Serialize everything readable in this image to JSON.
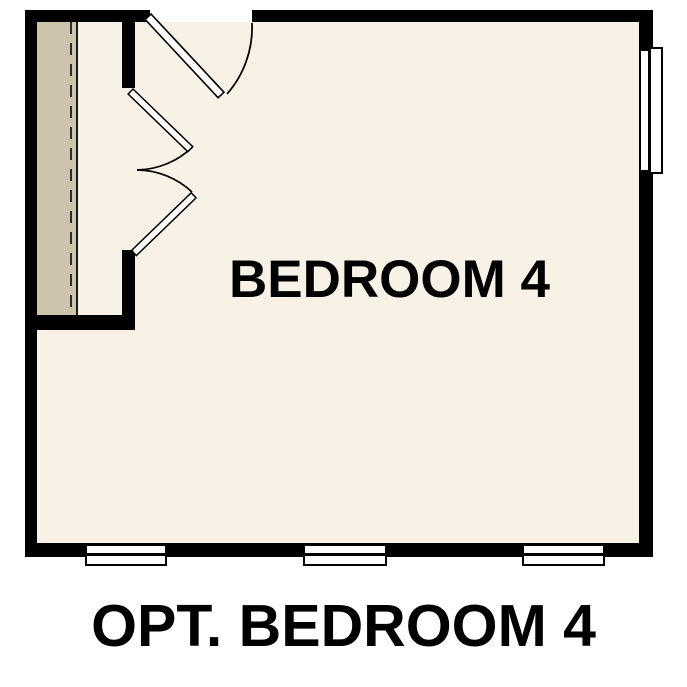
{
  "plan": {
    "room_label": "BEDROOM 4",
    "caption": "OPT. BEDROOM 4"
  },
  "colors": {
    "wall": "#000000",
    "floor": "#f8f1e5",
    "shade": "#cdc4ad",
    "ink": "#000000",
    "paper": "#ffffff"
  }
}
